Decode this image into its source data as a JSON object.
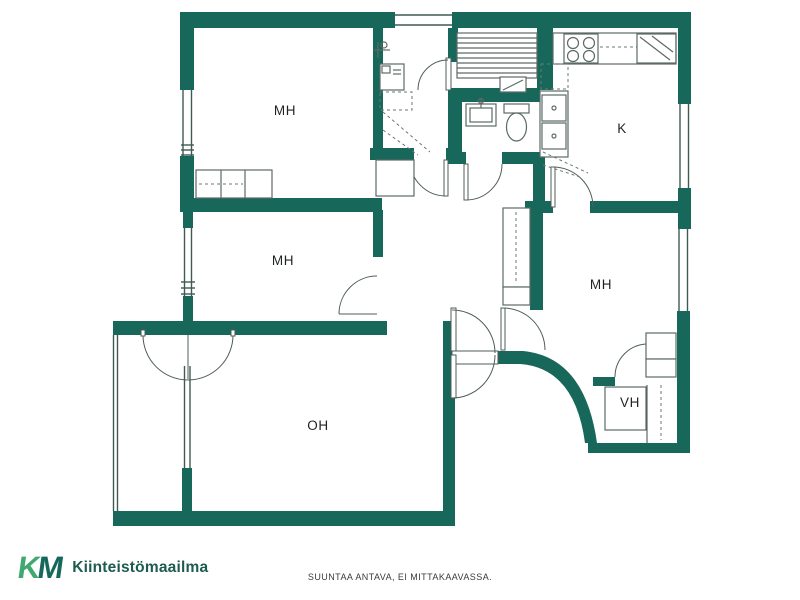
{
  "floorplan": {
    "rooms": [
      {
        "id": "bedroom-top-left",
        "label": "MH"
      },
      {
        "id": "bedroom-mid-left",
        "label": "MH"
      },
      {
        "id": "kitchen",
        "label": "K"
      },
      {
        "id": "bedroom-right",
        "label": "MH"
      },
      {
        "id": "living-room",
        "label": "OH"
      },
      {
        "id": "walk-in-closet",
        "label": "VH"
      }
    ],
    "colors": {
      "wall": "#17685A",
      "fixture_line": "#5c6a65",
      "window_frame": "#3f5a53",
      "room_label": "#1f2421"
    }
  },
  "footer": {
    "logo": {
      "k": "K",
      "m": "M",
      "name": "Kiinteistömaailma",
      "k_color": "#41A96F",
      "m_color": "#17685A",
      "name_color": "#1D5B51"
    },
    "disclaimer": "SUUNTAA ANTAVA, EI MITTAKAAVASSA."
  }
}
